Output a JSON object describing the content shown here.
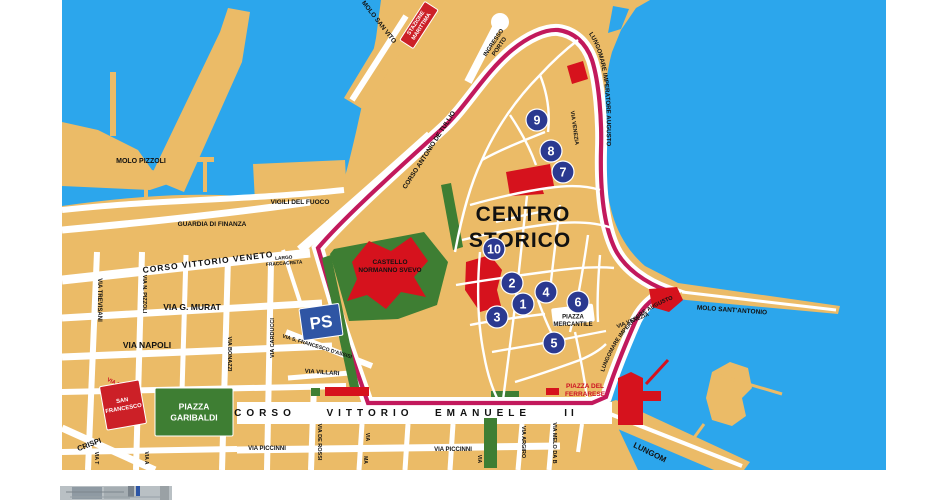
{
  "colors": {
    "sea": "#2ca6ec",
    "land": "#ebbb67",
    "road": "#ffffff",
    "ring": "#c2195c",
    "green": "#3e7e33",
    "red": "#d6121d",
    "navy": "#2b3990",
    "ps_blue": "#2f55a4",
    "box_red": "#cc2027",
    "label_red": "#cc1122",
    "black": "#111111",
    "photo_gray": "#b9c0c4"
  },
  "map": {
    "labels": [
      {
        "id": "label-molo-pizzoli",
        "t": "MOLO PIZZOLI",
        "x": 141,
        "y": 161,
        "rot": 0,
        "size": 7
      },
      {
        "id": "label-vigili-del-fuoco",
        "t": "VIGILI DEL FUOCO",
        "x": 300,
        "y": 202,
        "rot": 0,
        "size": 6.5
      },
      {
        "id": "label-guardia-di-finanza",
        "t": "GUARDIA DI FINANZA",
        "x": 212,
        "y": 224,
        "rot": 0,
        "size": 6.5
      },
      {
        "id": "label-molo-san-vito",
        "t": "MOLO SAN VITO",
        "x": 379,
        "y": 22,
        "rot": 52,
        "size": 6.5
      },
      {
        "id": "label-ingresso-porto",
        "lines": [
          "INGRESSO",
          "PORTO"
        ],
        "x": 497,
        "y": 45,
        "rot": -56,
        "size": 6,
        "lh": 7
      },
      {
        "id": "label-corso-antonio-de-tullio",
        "t": "CORSO ANTONIO DE TULLIO",
        "x": 429,
        "y": 150,
        "rot": -57,
        "size": 6.5
      },
      {
        "id": "label-via-venezia-nord",
        "t": "VIA VENEZIA",
        "x": 574,
        "y": 128,
        "rot": 82,
        "size": 5.5
      },
      {
        "id": "label-via-venezia-est",
        "t": "VIA VENEZIA",
        "x": 633,
        "y": 321,
        "rot": -22,
        "size": 5.5
      },
      {
        "id": "label-molo-sant-antonio",
        "t": "MOLO SANT'ANTONIO",
        "x": 732,
        "y": 310,
        "rot": 4,
        "size": 6.5
      },
      {
        "id": "label-centro",
        "t": "CENTRO",
        "x": 523,
        "y": 214,
        "rot": 0,
        "size": 21,
        "ls": 1
      },
      {
        "id": "label-storico",
        "t": "STORICO",
        "x": 520,
        "y": 240,
        "rot": 0,
        "size": 21,
        "ls": 1
      },
      {
        "id": "label-castello-normanno-svevo",
        "lines": [
          "CASTELLO",
          "NORMANNO SVEVO"
        ],
        "x": 390,
        "y": 266,
        "rot": 0,
        "size": 6.5,
        "lh": 8
      },
      {
        "id": "label-piazza-mercantile",
        "lines": [
          "PIAZZA",
          "MERCANTILE"
        ],
        "x": 573,
        "y": 321,
        "rot": 0,
        "size": 6,
        "lh": 7.5
      },
      {
        "id": "label-piazza-del-ferrarese",
        "lines": [
          "PIAZZA DEL",
          "FERRARESE"
        ],
        "x": 585,
        "y": 390,
        "rot": 0,
        "size": 6.5,
        "lh": 8,
        "color": "#cc1122"
      },
      {
        "id": "label-corso-vittorio-veneto",
        "t": "CORSO VITTORIO VENETO",
        "x": 208,
        "y": 262,
        "rot": -7,
        "size": 8.5,
        "ls": 1
      },
      {
        "id": "label-largo-fraccacreta",
        "lines": [
          "LARGO",
          "FRACCACRETA"
        ],
        "x": 284,
        "y": 261,
        "rot": -4,
        "size": 4.8,
        "lh": 5.5
      },
      {
        "id": "label-via-trevisani",
        "t": "VIA TREVISANI",
        "x": 99,
        "y": 300,
        "rot": 90,
        "size": 6
      },
      {
        "id": "label-via-n-pizzoli",
        "t": "VIA N. PIZZOLI",
        "x": 144,
        "y": 294,
        "rot": 90,
        "size": 5.5
      },
      {
        "id": "label-via-g-murat",
        "t": "VIA G. MURAT",
        "x": 192,
        "y": 307,
        "rot": 0,
        "size": 8.5
      },
      {
        "id": "label-via-napoli",
        "t": "VIA NAPOLI",
        "x": 147,
        "y": 345,
        "rot": 0,
        "size": 8.5
      },
      {
        "id": "label-via-bonazzi",
        "t": "VIA BONAZZI",
        "x": 229,
        "y": 354,
        "rot": 90,
        "size": 5.5
      },
      {
        "id": "label-via-carducci",
        "t": "VIA CARDUCCI",
        "x": 273,
        "y": 338,
        "rot": -90,
        "size": 5.5
      },
      {
        "id": "label-via-s-francesco-d-assisi",
        "t": "VIA S. FRANCESCO D'ASSISI",
        "x": 317,
        "y": 347,
        "rot": 17,
        "size": 5.2
      },
      {
        "id": "label-via-villari",
        "t": "VIA VILLARI",
        "x": 322,
        "y": 373,
        "rot": 4,
        "size": 6
      },
      {
        "id": "label-via-perrone",
        "t": "VIA PERRONE",
        "x": 124,
        "y": 388,
        "rot": 26,
        "size": 5.5,
        "color": "#cc1122"
      },
      {
        "id": "label-corso",
        "t": "CORSO",
        "x": 265,
        "y": 413,
        "rot": 0,
        "size": 10,
        "ls": 5
      },
      {
        "id": "label-vittorio",
        "t": "VITTORIO",
        "x": 370,
        "y": 413,
        "rot": 0,
        "size": 10,
        "ls": 5
      },
      {
        "id": "label-emanuele",
        "t": "EMANUELE",
        "x": 483,
        "y": 413,
        "rot": 0,
        "size": 10,
        "ls": 5
      },
      {
        "id": "label-ii",
        "t": "II",
        "x": 571,
        "y": 413,
        "rot": 0,
        "size": 10,
        "ls": 4
      },
      {
        "id": "label-via-piccinni-ovest",
        "t": "VIA PICCINNI",
        "x": 267,
        "y": 449,
        "rot": 0,
        "size": 6
      },
      {
        "id": "label-via-piccinni-est",
        "t": "VIA PICCINNI",
        "x": 453,
        "y": 450,
        "rot": 0,
        "size": 6
      },
      {
        "id": "label-via-de-rossi",
        "t": "VIA DE ROSSI",
        "x": 319,
        "y": 442,
        "rot": 90,
        "size": 5.5
      },
      {
        "id": "label-via-argiro",
        "t": "VIA ARGIRO",
        "x": 523,
        "y": 442,
        "rot": 90,
        "size": 5.5
      },
      {
        "id": "label-via-melo",
        "t": "VIA MELO DA B",
        "x": 554,
        "y": 443,
        "rot": 90,
        "size": 5.5
      },
      {
        "id": "label-crispi",
        "t": "CRISPI",
        "x": 89,
        "y": 444,
        "rot": -21,
        "size": 7.5
      },
      {
        "id": "label-lungomare-sud",
        "t": "LUNGOM",
        "x": 650,
        "y": 452,
        "rot": 26,
        "size": 8
      },
      {
        "id": "label-via-t",
        "t": "VIA T",
        "x": 96,
        "y": 458,
        "rot": 90,
        "size": 5
      },
      {
        "id": "label-via-a",
        "t": "VIA A",
        "x": 146,
        "y": 458,
        "rot": 90,
        "size": 5
      },
      {
        "id": "label-via-cut-1",
        "t": "VIA",
        "x": 367,
        "y": 437,
        "rot": 90,
        "size": 5
      },
      {
        "id": "label-via-cut-2",
        "t": "MA",
        "x": 365,
        "y": 460,
        "rot": 90,
        "size": 5
      },
      {
        "id": "label-via-cut-3",
        "t": "VIA",
        "x": 479,
        "y": 459,
        "rot": 90,
        "size": 5
      }
    ],
    "path_labels": [
      {
        "id": "label-lungomare-imperatore-augusto-nord",
        "t": "LUNGOMARE IMPERATORE AUGUSTO",
        "path": "coastTopPath",
        "size": 6.2,
        "off": "2%"
      },
      {
        "id": "label-lungomare-imperatore-augusto-est",
        "t": "LUNGOMARE IMPERATORE AUGUSTO",
        "path": "coastEastPath",
        "size": 5.6,
        "off": "0%"
      }
    ],
    "boxes": [
      {
        "id": "stazione-marittima-box",
        "lines": [
          "STAZIONE",
          "MARITTIMA"
        ],
        "x": 419,
        "y": 25,
        "rot": -57,
        "w": 46,
        "h": 16,
        "bg": "#cc2027",
        "fg": "#ffffff",
        "size": 5.5,
        "lh": 6.5
      },
      {
        "id": "ps-box",
        "lines": [
          "PS"
        ],
        "x": 321,
        "y": 322,
        "rot": -8,
        "w": 40,
        "h": 32,
        "bg": "#2f55a4",
        "fg": "#ffffff",
        "size": 17,
        "lh": 0
      },
      {
        "id": "san-francesco-box",
        "lines": [
          "SAN",
          "FRANCESCO"
        ],
        "x": 123,
        "y": 405,
        "rot": -10,
        "w": 40,
        "h": 44,
        "bg": "#cc2027",
        "fg": "#ffffff",
        "size": 5.8,
        "lh": 8
      },
      {
        "id": "piazza-garibaldi-box",
        "lines": [
          "PIAZZA",
          "GARIBALDI"
        ],
        "x": 194,
        "y": 412,
        "rot": 0,
        "w": 78,
        "h": 48,
        "bg": "#3e7e33",
        "fg": "#ffffff",
        "size": 8.5,
        "lh": 11
      }
    ],
    "markers": [
      {
        "n": "1",
        "x": 523,
        "y": 304
      },
      {
        "n": "2",
        "x": 512,
        "y": 283
      },
      {
        "n": "3",
        "x": 497,
        "y": 317
      },
      {
        "n": "4",
        "x": 546,
        "y": 292
      },
      {
        "n": "5",
        "x": 554,
        "y": 343
      },
      {
        "n": "6",
        "x": 578,
        "y": 302
      },
      {
        "n": "7",
        "x": 563,
        "y": 172
      },
      {
        "n": "8",
        "x": 551,
        "y": 151
      },
      {
        "n": "9",
        "x": 537,
        "y": 120
      },
      {
        "n": "10",
        "x": 494,
        "y": 249
      }
    ]
  }
}
